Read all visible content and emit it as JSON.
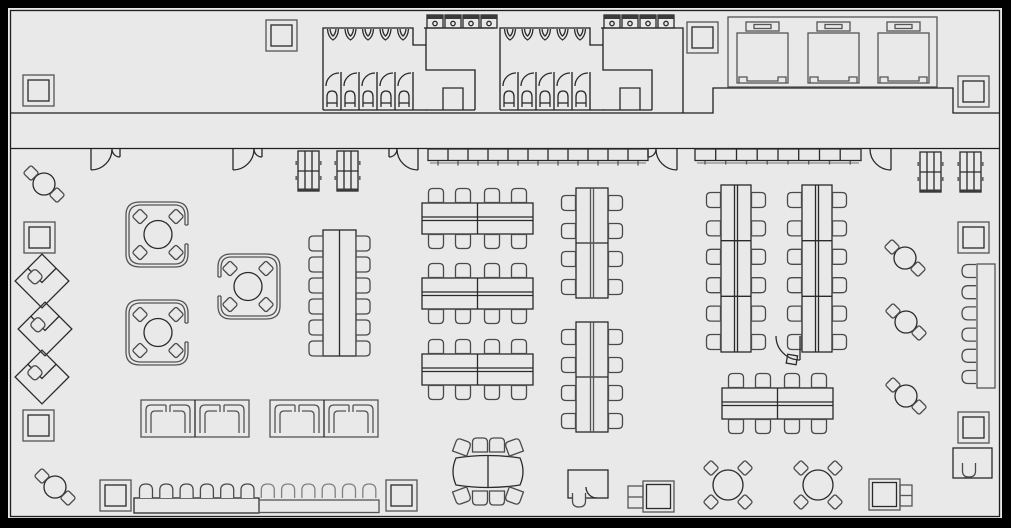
{
  "plan": {
    "label": "Office floor plan",
    "colors": {
      "background": "#e9e9e9",
      "frame": "#000000",
      "wall": "#1f1f1f",
      "furniture_dark": "#2a2a2a",
      "furniture_mid": "#555555",
      "furniture_light": "#8a8a8a"
    },
    "rooms": {
      "restroom_blocks": 2,
      "elevator_cars": 3
    },
    "fixtures": {
      "toilet_stalls_per_block": 5,
      "sinks_per_block": 5,
      "wall_fixtures_per_block": 4,
      "columns": 10,
      "top_wall_doors": 5,
      "corridor_shelf_units": 4,
      "segmented_wall_counters": 2
    },
    "furniture": {
      "privacy_pods": 3,
      "pod_seats_each": 4,
      "diagonal_workstations": 3,
      "round_tables_2_seat": 5,
      "round_tables_4_seat": 2,
      "horizontal_table_pairs": 4,
      "vertical_table_pairs": 2,
      "vertical_long_tables": 3,
      "conference_oval_tables": 1,
      "booth_lounge_groups": 2,
      "bar_stools": 12,
      "right_wall_stools": 6,
      "l_shaped_desks": 2,
      "copiers": 2
    }
  }
}
